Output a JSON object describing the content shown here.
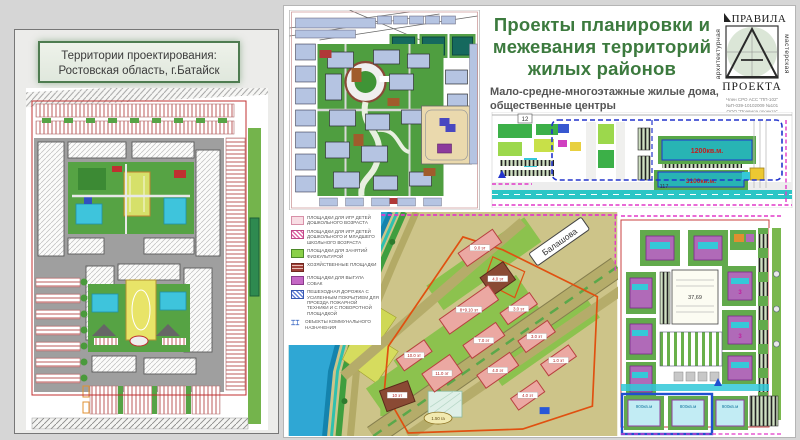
{
  "left_panel": {
    "title_line1": "Территории проектирования:",
    "title_line2": "Ростовская область, г.Батайск"
  },
  "header": {
    "title_line1": "Проекты планировки и",
    "title_line2": "межевания территорий",
    "title_line3": "жилых районов",
    "title_color": "#3c7a3e",
    "subtitle_line1": "Мало-средне-многоэтажные жилые дома,",
    "subtitle_line2": "общественные центры"
  },
  "logo": {
    "word_top": "ПРАВИЛА",
    "word_bottom": "ПРОЕКТА",
    "side_left": "архитектурная",
    "side_right": "мастерская",
    "cert_line1": "Член СРО АСС \"ПП-102\"",
    "cert_line2": "№П-039-10102009 №101",
    "cert_line3": "ООО \"Правила проекта\""
  },
  "legend": {
    "items": [
      {
        "label": "ПЛОЩАДКИ ДЛЯ ИГР ДЕТЕЙ ДОШКОЛЬНОГО ВОЗРАСТА",
        "color": "#f2b8c6"
      },
      {
        "label": "ПЛОЩАДКИ ДЛЯ ИГР ДЕТЕЙ ДОШКОЛЬНОГО И МЛАДШЕГО ШКОЛЬНОГО ВОЗРАСТА",
        "color": "#e06aa8"
      },
      {
        "label": "ПЛОЩАДКИ ДЛЯ ЗАНЯТИЙ ФИЗКУЛЬТУРОЙ",
        "color": "#8ad048"
      },
      {
        "label": "ХОЗЯЙСТВЕННЫЕ ПЛОЩАДКИ",
        "color": "#a04038"
      },
      {
        "label": "ПЛОЩАДКИ ДЛЯ ВЫГУЛА СОБАК",
        "color": "#c568c5"
      },
      {
        "label": "ПЕШЕХОДНАЯ ДОРОЖКА С УСИЛЕННЫМ ПОКРЫТИЕМ ДЛЯ ПРОЕЗДА ПОЖАРНОЙ ТЕХНИКИ И С ПОВОРОТНОЙ ПЛОЩАДКОЙ",
        "color": "#6a86d8"
      },
      {
        "label": "ОБЪЕКТЫ КОММУНАЛЬНОГО НАЗНАЧЕНИЯ",
        "color": "#3060c0",
        "glyph": "⌶⌶"
      }
    ]
  },
  "map_top_right": {
    "area_label_1": "1200кв.м.",
    "area_label_2": "3100кв.м.",
    "street_number": "117",
    "block_number": "12"
  },
  "map_bottom_middle": {
    "street_name": "Балашова",
    "building_labels": [
      "9.0 эт",
      "4.0 эт",
      "8+9.10 эт",
      "7.0 эт",
      "4.0 эт",
      "3.0 эт",
      "3.0 эт",
      "1.0 эт",
      "10.0 эт",
      "11.0 эт",
      "10 эт",
      "4.0 эт"
    ],
    "area_note": "1.50 га"
  },
  "map_bottom_right": {
    "area_labels": [
      "900кв.м",
      "800кв.м",
      "900кв.м"
    ],
    "center_note": "37,69",
    "unit_mark": "3"
  },
  "colors": {
    "water": "#2fa7d4",
    "building_pink": "#eba8a2",
    "pool_teal": "#28b4b4",
    "lawn_green": "#56a344",
    "boundary_red": "#e05010",
    "plan_magenta": "#e238c8"
  }
}
